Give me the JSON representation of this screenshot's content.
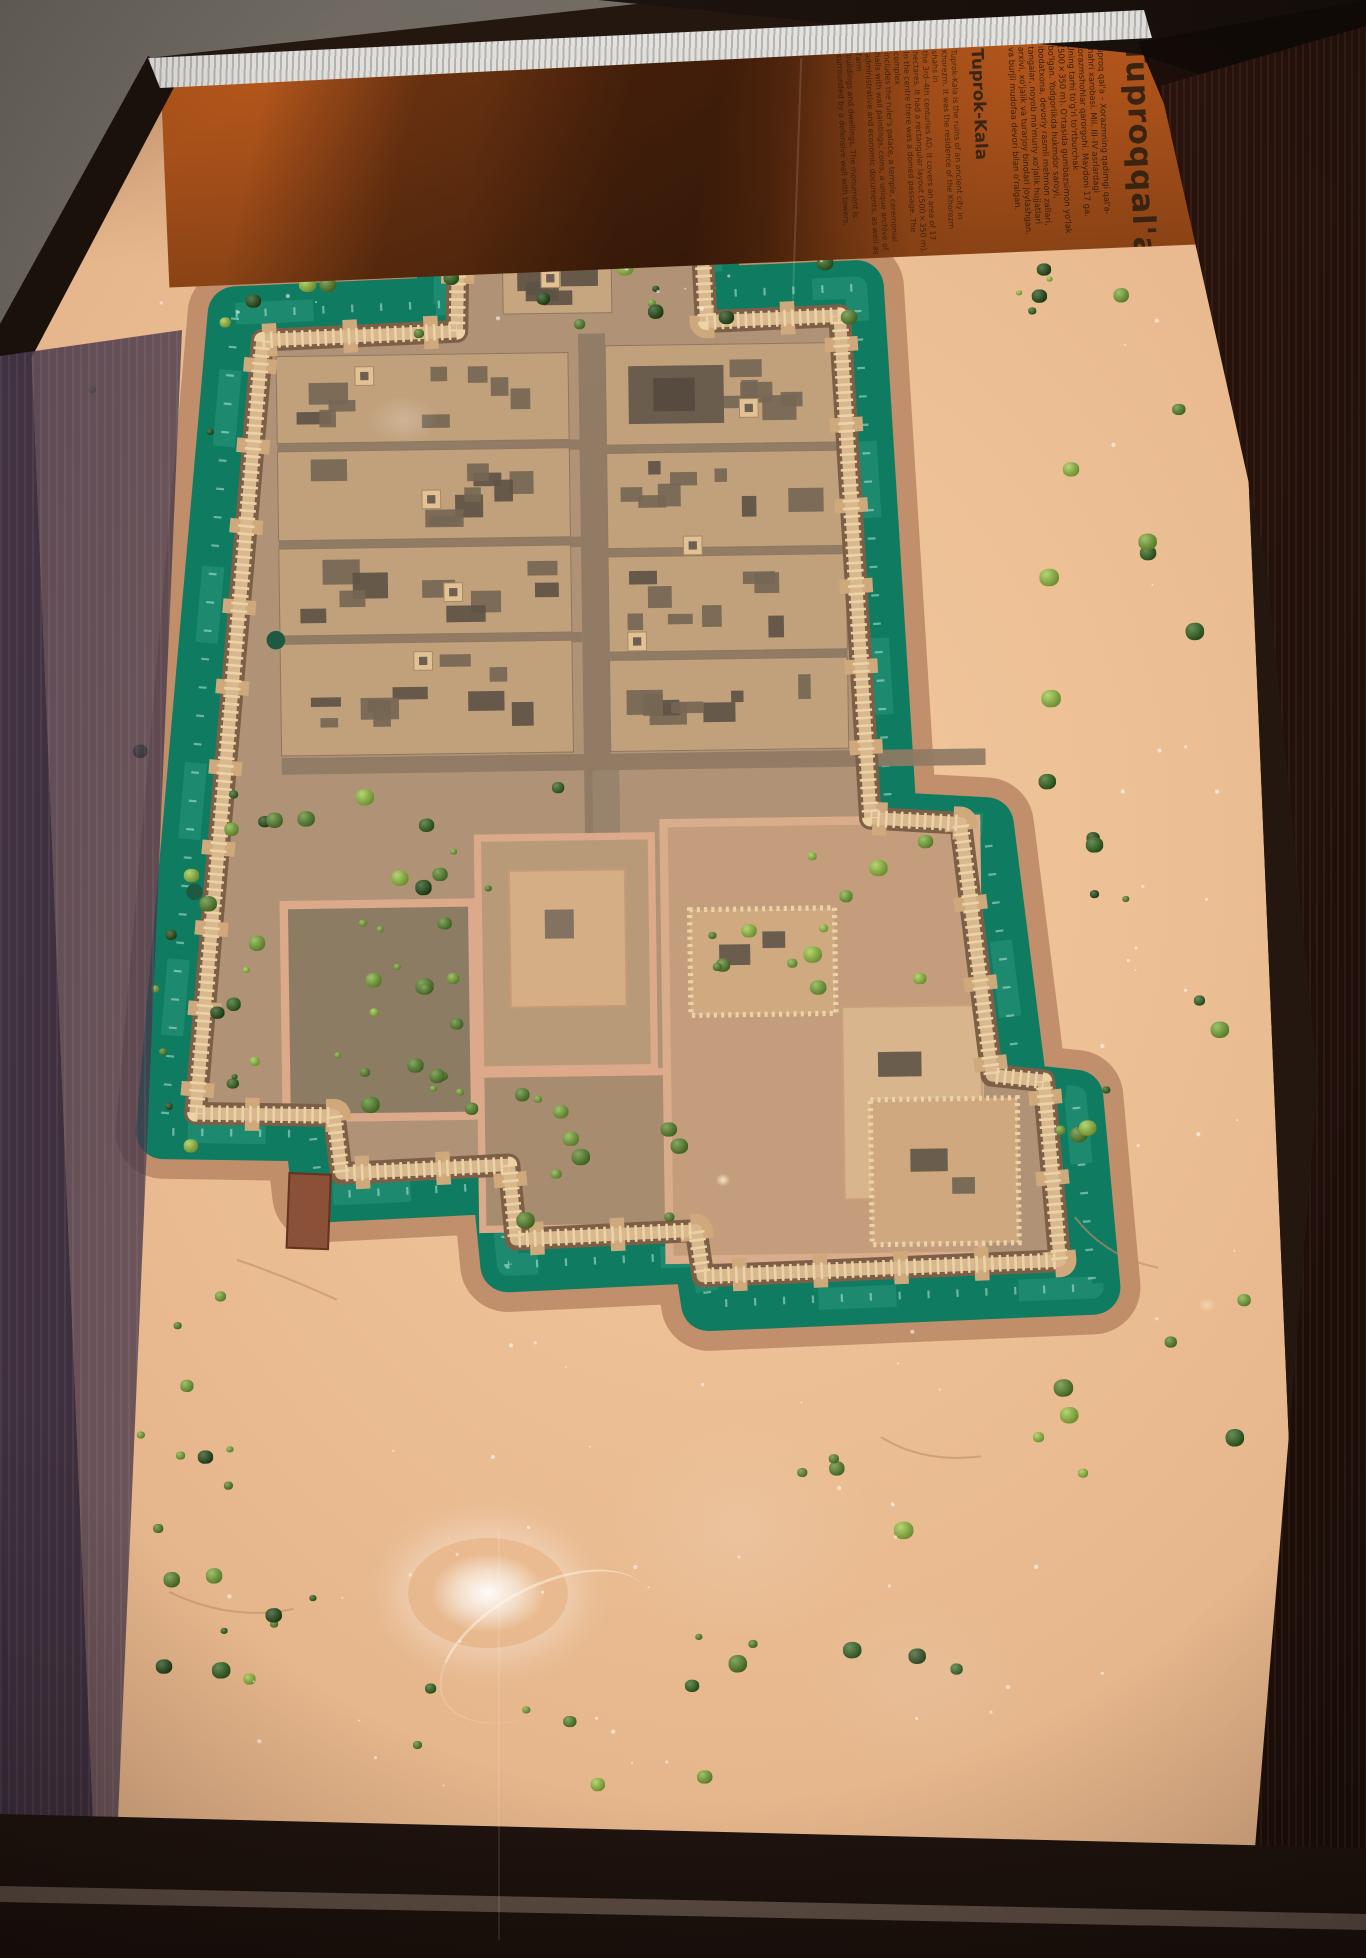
{
  "exhibit": {
    "description": "Museum display case with a scale model of the ancient fortified city of Tuproqqal'a (Toprak-Kala), viewed from above",
    "panel": {
      "uz_title": "Tuproqqal'a",
      "uz_body": "Tuproq qal'a – Xorazmning qadimgi qal'a-\nshahri xarobasi. Mil. III–IV asrlardagi\nxorazmshohlar qarorgohi. Maydoni 17 ga.\nUning tarhi to'g'ri to'rtburchak\n(500×350 m). O'rtasida gumbazsimon yo'lak\nbo'lgan. Yodgorlikda hukmdor saroyi,\nibodatxona, devoriy rasmli mehmon zallari,\ntangalar, noyob ma'muriy xo'jalik hujjatlari\narxivi, xo'jalik va turarjoy binolari joylashgan.\nva burjli mudofaa devori bilan o'ralgan.",
      "en_title": "Tuprok-Kala",
      "en_body": "Tuprok-Kala is the ruins of an ancient city in\nKhorezm. It was the residence of the Khorezm shahs in\nthe 3rd–4th centuries AD. It covers an area of 17\nhectares. It had a rectangular layout (500×350 m).\nIn the centre there was a domed passage. The complex\nincludes the ruler's palace, a temple, ceremonial\nhalls with wall paintings, coins, a unique archive of\nadministrative and economic documents, as well as farm\nbuildings and dwellings. The monument is\nsurrounded by a defensive wall with towers."
    },
    "colors": {
      "panel_orange": "#b4571c",
      "moat_teal": "#0f7b61",
      "moat_light": "#2f9e80",
      "sand": "#e9bd95",
      "wall_cream": "#d9b88f",
      "wall_teeth": "#ecd3a6",
      "embankment": "#bb8a66",
      "city_ground": "#b09376",
      "block_tan": "#c1a17c",
      "room_dark": "#756654",
      "case_black": "#140e0a"
    },
    "foliage_palette": [
      "#9cc943",
      "#7fae3a",
      "#5d8a2e",
      "#36691f",
      "#274f18"
    ]
  }
}
